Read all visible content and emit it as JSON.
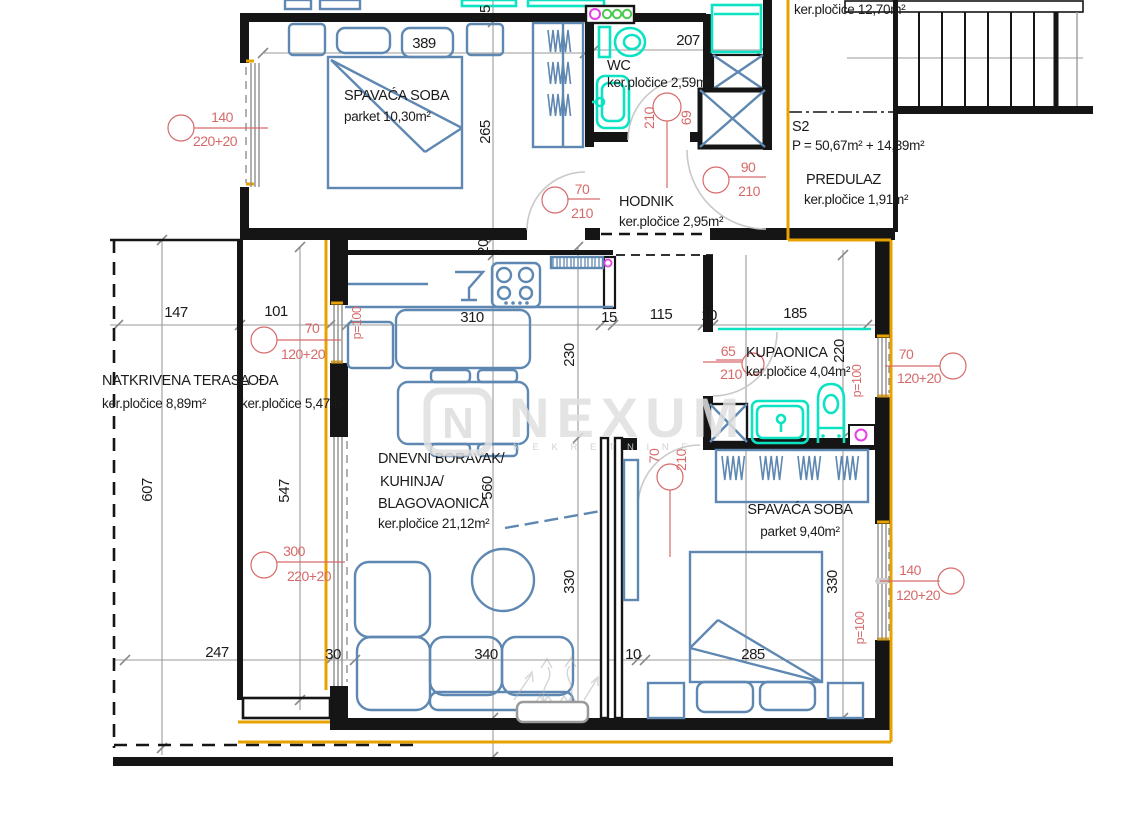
{
  "watermark": {
    "brand": "NEXUM",
    "logo_letter": "N",
    "tagline": "N E K R E T N I N E"
  },
  "unit": {
    "id": "S2",
    "area": "P = 50,67m² + 14,39m²"
  },
  "rooms": {
    "bedroom1": {
      "name": "SPAVAĆA SOBA",
      "finish": "parket 10,30m²"
    },
    "wc": {
      "name": "WC",
      "finish": "ker.pločice 2,59m²"
    },
    "hodnik": {
      "name": "HODNIK",
      "finish": "ker.pločice 2,95m²"
    },
    "predulaz": {
      "name": "PREDULAZ",
      "finish": "ker.pločice 1,91m²"
    },
    "stair_hall": {
      "finish": "ker.pločice 12,70m²"
    },
    "terasa": {
      "name": "NATKRIVENA TERASA",
      "finish": "ker.pločice 8,89m²"
    },
    "lodja": {
      "name": "LOĐA",
      "finish": "ker.pločice 5,47m²"
    },
    "living": {
      "line1": "DNEVNI BORAVAK/",
      "line2": "KUHINJA/",
      "line3": "BLAGOVAONICA",
      "finish": "ker.pločice 21,12m²"
    },
    "kupaonica": {
      "name": "KUPAONICA",
      "finish": "ker.pločice 4,04m²"
    },
    "bedroom2": {
      "name": "SPAVAĆA SOBA",
      "finish": "parket 9,40m²"
    }
  },
  "dims": {
    "top_389": "389",
    "top_207": "207",
    "v_25": "25",
    "v_265": "265",
    "v_20": "20",
    "v_560": "560",
    "v_230": "230",
    "v_330_living": "330",
    "v_220": "220",
    "v_330_bed": "330",
    "v_607": "607",
    "v_547": "547",
    "mid_147": "147",
    "mid_101": "101",
    "mid_310": "310",
    "mid_15": "15",
    "mid_115": "115",
    "mid_10": "10",
    "mid_185": "185",
    "bot_247": "247",
    "bot_30": "30",
    "bot_340": "340",
    "bot_10": "10",
    "bot_285": "285"
  },
  "openings": {
    "win_bedroom1": {
      "w": "140",
      "h": "220+20"
    },
    "door_bedroom1": {
      "w": "70",
      "h": "210"
    },
    "door_wc": {
      "w": "69",
      "h": "210"
    },
    "door_hodnik": {
      "w": "90",
      "h": "210"
    },
    "win_lodja": {
      "w": "70",
      "h": "120+20"
    },
    "door_lodja": {
      "w": "300",
      "h": "220+20"
    },
    "door_kupaonica": {
      "w": "65",
      "h": "210"
    },
    "win_kupaonica": {
      "w": "70",
      "h": "120+20"
    },
    "door_bedroom2": {
      "w": "70",
      "h": "210"
    },
    "win_bedroom2": {
      "w": "140",
      "h": "120+20"
    },
    "parapet": "p=100"
  },
  "colors": {
    "furniture_blue": "#5e88b2",
    "sanitary_cyan": "#0be3c3",
    "dimension_red": "#d66a6a",
    "accent_orange": "#e8a200",
    "wall_black": "#151515",
    "dim_gray": "#9a9a9a"
  }
}
